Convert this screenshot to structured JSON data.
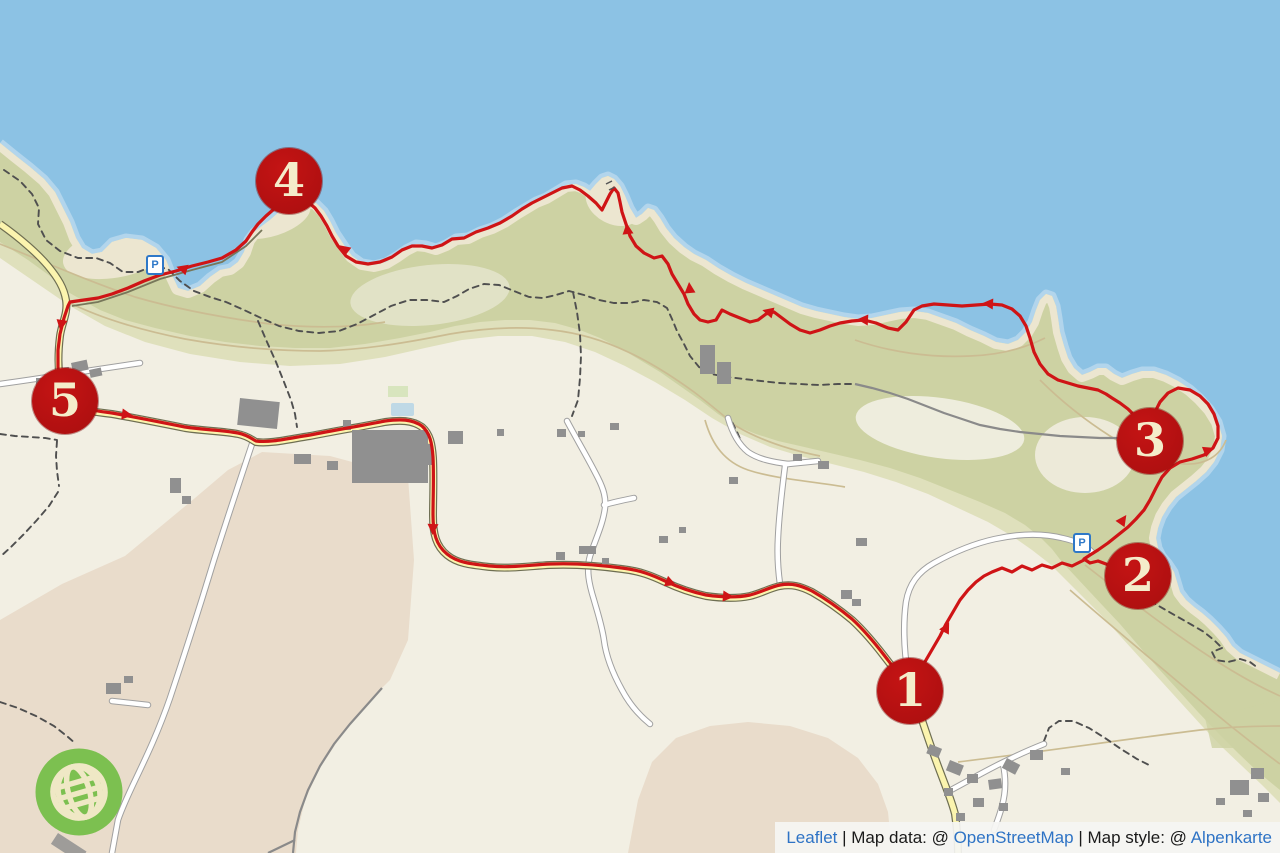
{
  "map": {
    "title": "Coastal hiking route map with numbered waypoints",
    "markers": [
      {
        "label": "1",
        "x": 910,
        "y": 691
      },
      {
        "label": "2",
        "x": 1138,
        "y": 576
      },
      {
        "label": "3",
        "x": 1150,
        "y": 441
      },
      {
        "label": "4",
        "x": 289,
        "y": 181
      },
      {
        "label": "5",
        "x": 65,
        "y": 401
      }
    ],
    "parking_icons": [
      {
        "label": "P",
        "x": 155,
        "y": 265
      },
      {
        "label": "P",
        "x": 1082,
        "y": 543
      }
    ],
    "attribution": {
      "leaflet_link": "Leaflet",
      "separator1": " | ",
      "map_data_label": "Map data: @ ",
      "openstreetmap_link": "OpenStreetMap",
      "separator2": " | ",
      "map_style_label": "Map style: @ ",
      "alpenkarte_link": "Alpenkarte"
    },
    "colors": {
      "water": "#8cc2e4",
      "shallow_water": "#b2d5ec",
      "land": "#f2efe3",
      "coastal_scrub_dark": "#cdd2a3",
      "coastal_scrub_light": "#dfe0bc",
      "beach_cliff": "#ece6d0",
      "farm_field": "#e9dccb",
      "route_red": "#cf1416",
      "marker_red": "#b91111",
      "marker_number": "#f4ecca",
      "yellow_road": "#fbf4ae",
      "yellow_road_casing": "#6e6e52",
      "white_road_casing": "#a0a0a0",
      "building_gray": "#909090",
      "trail_dash": "#4f4f4f",
      "attribution_link_blue": "#2e73c5",
      "logo_green": "#7cc050"
    }
  }
}
